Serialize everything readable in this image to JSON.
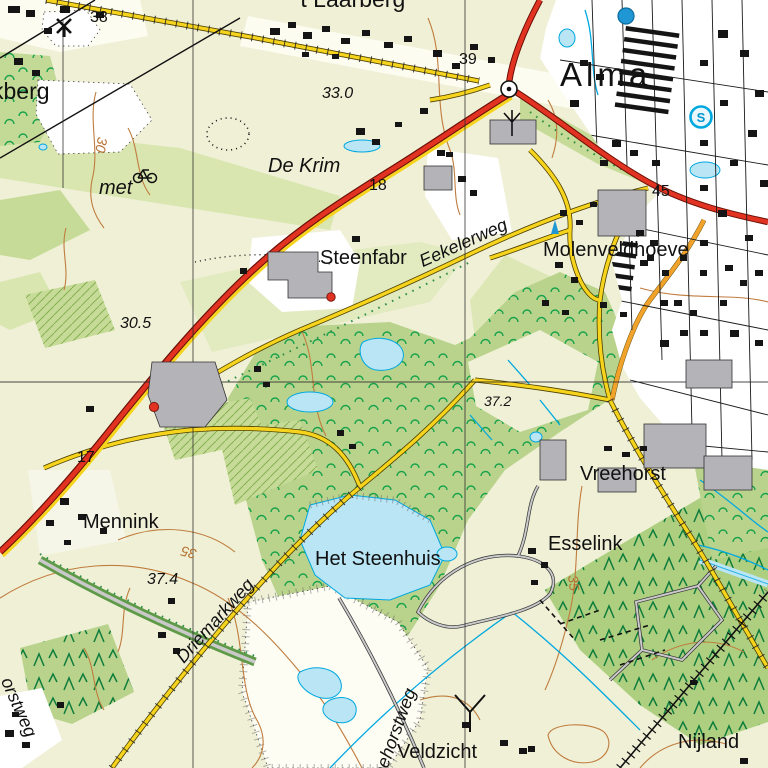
{
  "map": {
    "kind": "topographic-map",
    "colors": {
      "field": "#eff0d6",
      "field_alt": "#e2eac0",
      "pasture": "#d9e6b0",
      "meadow": "#c6db97",
      "forest": "#b9d38c",
      "conifer_area": "#aecf80",
      "tree_symbol": "#18a24c",
      "conifer_symbol": "#0e7c3c",
      "water_fill": "#b9e5f4",
      "water_line": "#00a8e0",
      "road_red": "#e23322",
      "road_yellow": "#f6d31d",
      "road_orange": "#f0a22a",
      "road_grey": "#c9c9c9",
      "building_black": "#151515",
      "building_grey": "#b3b3b8",
      "contour": "#c07c3e",
      "urban": "#ffffff",
      "label": "#111111"
    },
    "labels": [
      {
        "id": "kberg",
        "text": "kberg",
        "x": -8,
        "y": 80,
        "rot": 0,
        "cls": "name lg"
      },
      {
        "id": "spot-38",
        "text": "38",
        "x": 90,
        "y": 10,
        "rot": 0,
        "cls": "num"
      },
      {
        "id": "t-laarberg",
        "text": "'t Laarberg",
        "x": 296,
        "y": -12,
        "rot": 0,
        "cls": "name lg"
      },
      {
        "id": "spot-39",
        "text": "39",
        "x": 459,
        "y": 52,
        "rot": 0,
        "cls": "num"
      },
      {
        "id": "alma",
        "text": "Alma",
        "x": 560,
        "y": 58,
        "rot": 0,
        "cls": "town"
      },
      {
        "id": "height-33-0",
        "text": "33.0",
        "x": 322,
        "y": 86,
        "rot": 0,
        "cls": "height"
      },
      {
        "id": "contour-30",
        "text": "30",
        "x": 96,
        "y": 122,
        "rot": 100,
        "cls": "contour"
      },
      {
        "id": "de-krim",
        "text": "De Krim",
        "x": 268,
        "y": 156,
        "rot": 0,
        "cls": "farm-it"
      },
      {
        "id": "met",
        "text": "met",
        "x": 99,
        "y": 178,
        "rot": 0,
        "cls": "farm-it"
      },
      {
        "id": "spot-18",
        "text": "18",
        "x": 369,
        "y": 178,
        "rot": 0,
        "cls": "num"
      },
      {
        "id": "steenfabr",
        "text": "Steenfabr",
        "x": 320,
        "y": 248,
        "rot": 0,
        "cls": "name"
      },
      {
        "id": "eekelerweg",
        "text": "Eekelerweg",
        "x": 424,
        "y": 252,
        "rot": -24,
        "cls": "road"
      },
      {
        "id": "molenveldhoeve",
        "text": "Molenveldhoeve",
        "x": 543,
        "y": 240,
        "rot": 0,
        "cls": "name"
      },
      {
        "id": "spot-45",
        "text": "45",
        "x": 652,
        "y": 184,
        "rot": 0,
        "cls": "num"
      },
      {
        "id": "height-30-5",
        "text": "30.5",
        "x": 120,
        "y": 316,
        "rot": 0,
        "cls": "height"
      },
      {
        "id": "height-37-2",
        "text": "37.2",
        "x": 484,
        "y": 394,
        "rot": 0,
        "cls": "height sm"
      },
      {
        "id": "spot-17",
        "text": "17",
        "x": 77,
        "y": 450,
        "rot": 0,
        "cls": "num"
      },
      {
        "id": "vreehorst",
        "text": "Vreehorst",
        "x": 580,
        "y": 464,
        "rot": 0,
        "cls": "name"
      },
      {
        "id": "mennink",
        "text": "Mennink",
        "x": 83,
        "y": 512,
        "rot": 0,
        "cls": "name"
      },
      {
        "id": "esselink",
        "text": "Esselink",
        "x": 548,
        "y": 534,
        "rot": 0,
        "cls": "name"
      },
      {
        "id": "contour-35-esselink",
        "text": "35",
        "x": 566,
        "y": 562,
        "rot": 83,
        "cls": "contour"
      },
      {
        "id": "contour-35-mennink",
        "text": "35",
        "x": 198,
        "y": 534,
        "rot": 195,
        "cls": "contour"
      },
      {
        "id": "het-steenhuis",
        "text": "Het Steenhuis",
        "x": 315,
        "y": 549,
        "rot": 0,
        "cls": "name"
      },
      {
        "id": "height-37-4",
        "text": "37.4",
        "x": 147,
        "y": 572,
        "rot": 0,
        "cls": "height"
      },
      {
        "id": "driemarkweg",
        "text": "Driemarkweg",
        "x": 186,
        "y": 648,
        "rot": -48,
        "cls": "road"
      },
      {
        "id": "vreehorstweg",
        "text": "Vreehorstweg",
        "x": 381,
        "y": 778,
        "rot": -70,
        "cls": "road"
      },
      {
        "id": "orstweg",
        "text": "orstweg",
        "x": -2,
        "y": 664,
        "rot": 66,
        "cls": "road"
      },
      {
        "id": "veldzicht",
        "text": "Veldzicht",
        "x": 397,
        "y": 742,
        "rot": 0,
        "cls": "name"
      },
      {
        "id": "nijland",
        "text": "Nijland",
        "x": 678,
        "y": 732,
        "rot": 0,
        "cls": "name"
      }
    ],
    "icons": [
      {
        "name": "windmill-icon",
        "x": 64,
        "y": 26
      },
      {
        "name": "bicycle-route-icon",
        "x": 138,
        "y": 172
      },
      {
        "name": "roundabout-icon",
        "x": 509,
        "y": 89
      },
      {
        "name": "water-tower-icon",
        "x": 626,
        "y": 16
      },
      {
        "name": "swimming-pool-icon",
        "x": 701,
        "y": 117,
        "letter": "S"
      },
      {
        "name": "radio-mast-icon",
        "x": 512,
        "y": 122
      },
      {
        "name": "chimney-icon",
        "x": 331,
        "y": 297
      },
      {
        "name": "chimney-icon-2",
        "x": 154,
        "y": 407
      },
      {
        "name": "monument-icon",
        "x": 551,
        "y": 226
      }
    ]
  }
}
